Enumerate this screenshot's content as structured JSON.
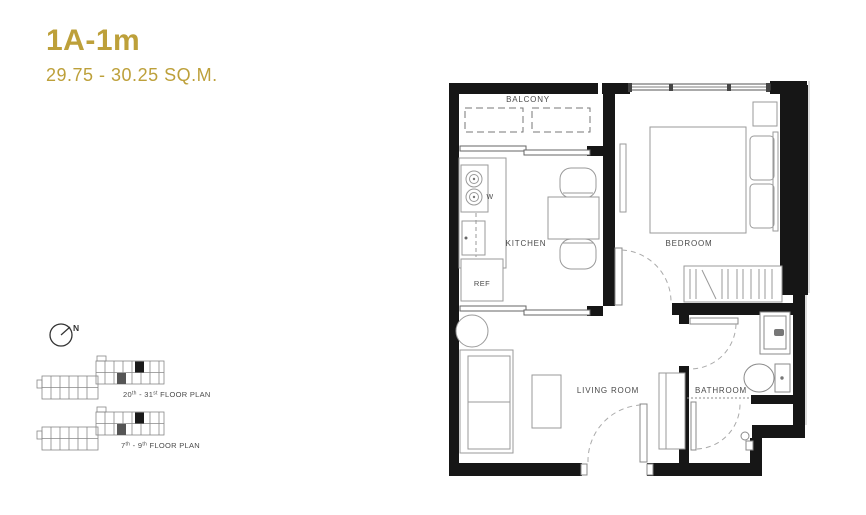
{
  "unit": {
    "code": "1A-1m",
    "area_range": "29.75 - 30.25 SQ.M."
  },
  "compass": {
    "north_label": "N"
  },
  "floor_plan": {
    "room_labels": {
      "balcony": "BALCONY",
      "kitchen": "KITCHEN",
      "bedroom": "BEDROOM",
      "living_room": "LIVING ROOM",
      "bathroom": "BATHROOM"
    },
    "fixture_labels": {
      "refrigerator": "REF",
      "washer": "W"
    }
  },
  "key_plans": [
    {
      "from": "20",
      "from_sup": "th",
      "mid": " - 31",
      "to_sup": "st",
      "tail": " FLOOR PLAN"
    },
    {
      "from": "7",
      "from_sup": "th",
      "mid": " - 9",
      "to_sup": "th",
      "tail": " FLOOR PLAN"
    }
  ],
  "colors": {
    "accent_gold": "#BDA03A",
    "wall_black": "#161616",
    "furniture_line": "#9a9a9a",
    "label_gray": "#4a4a4a"
  }
}
